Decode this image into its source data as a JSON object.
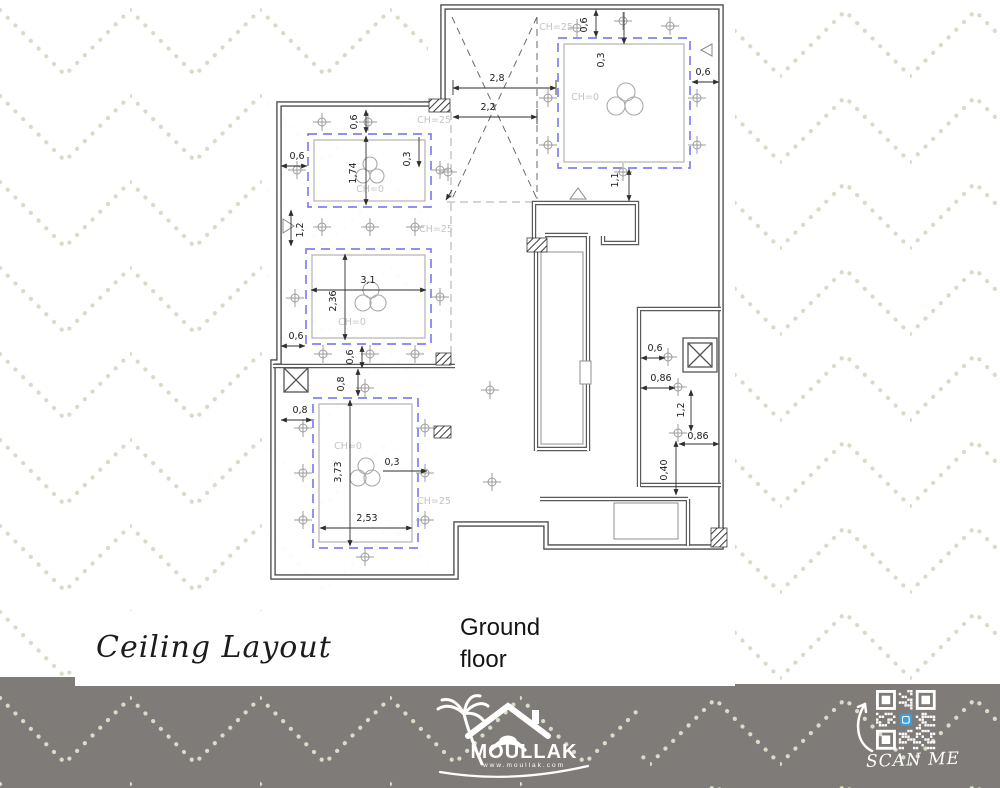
{
  "titles": {
    "drawing": "Ceiling Layout",
    "floor_line1": "Ground",
    "floor_line2": "floor"
  },
  "plan": {
    "labels": {
      "ch25": "CH=25",
      "ch0": "CH=0"
    },
    "dims": {
      "top_width_outer": "2,8",
      "top_width_inner": "2,2",
      "tr_top_gap": "0,6",
      "tr_inset": "0,3",
      "tr_right_gap": "0,6",
      "tr_bottom_gap": "1,1",
      "ul_top_gap": "0,6",
      "ul_left_gap": "0,6",
      "ul_height": "1,74",
      "ul_inset": "0,3",
      "left_wall_gap": "1,2",
      "ml_width": "3,1",
      "ml_height": "2,36",
      "ml_left_gap": "0,6",
      "ml_bottom_gap": "0,6",
      "bl_top_gap": "0,8",
      "bl_left_gap": "0,8",
      "bl_height": "3,73",
      "bl_inset": "0,3",
      "bl_width": "2,53",
      "rr_gap1": "0,6",
      "rr_gap2": "0,86",
      "rr_v": "1,2",
      "rr_gap3": "0,86",
      "rr_v2": "0,40"
    }
  },
  "footer": {
    "brand": "MOULLAK",
    "website": "www.moullak.com",
    "scan_me": "SCAN ME"
  },
  "colors": {
    "cove_dash": "#8080f0",
    "pattern_dot": "#d6dcc8",
    "footer_bg": "#7e7b78",
    "qr_icon": "#3f9fdd",
    "wall": "#4c4c4c"
  }
}
